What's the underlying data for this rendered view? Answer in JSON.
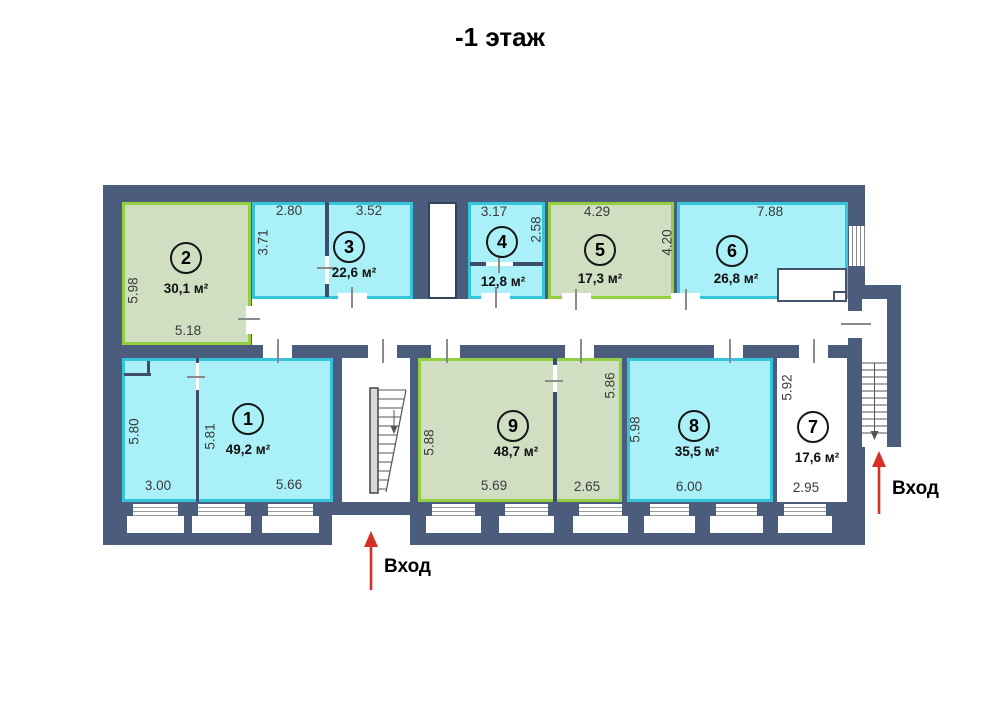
{
  "title": "-1 этаж",
  "entrances": {
    "bottom_label": "Вход",
    "right_label": "Вход"
  },
  "rooms": [
    {
      "number": "2",
      "area": "30,1 м²",
      "fill": "green"
    },
    {
      "number": "3",
      "area": "22,6 м²",
      "fill": "cyan"
    },
    {
      "number": "4",
      "area": "12,8 м²",
      "fill": "cyan"
    },
    {
      "number": "5",
      "area": "17,3 м²",
      "fill": "green"
    },
    {
      "number": "6",
      "area": "26,8 м²",
      "fill": "cyan"
    },
    {
      "number": "1",
      "area": "49,2 м²",
      "fill": "cyan"
    },
    {
      "number": "9",
      "area": "48,7 м²",
      "fill": "green"
    },
    {
      "number": "8",
      "area": "35,5 м²",
      "fill": "cyan"
    },
    {
      "number": "7",
      "area": "17,6 м²",
      "fill": "white"
    }
  ],
  "dimensions": {
    "room2_left": "5.98",
    "room2_bottom": "5.18",
    "room3_top_left": "2.80",
    "room3_top_right": "3.52",
    "room3_left": "3.71",
    "room4_top": "3.17",
    "room4_right": "2.58",
    "room5_top": "4.29",
    "room6_left": "4.20",
    "room6_top": "7.88",
    "room1_left": "5.80",
    "room1_mid": "5.81",
    "room1_bottom_left": "3.00",
    "room1_bottom_right": "5.66",
    "room9_left": "5.88",
    "room9_right": "5.86",
    "room9_bottom_left": "5.69",
    "room9_bottom_right": "2.65",
    "room8_left": "5.98",
    "room8_bottom": "6.00",
    "room7_left": "5.92",
    "room7_bottom": "2.95"
  },
  "colors": {
    "wall": "#4b5c7d",
    "cyan_fill": "#a9f0f8",
    "cyan_border": "#35c5db",
    "green_fill": "#d0dec2",
    "green_border": "#94ce41",
    "arrow_red": "#d62f28"
  }
}
